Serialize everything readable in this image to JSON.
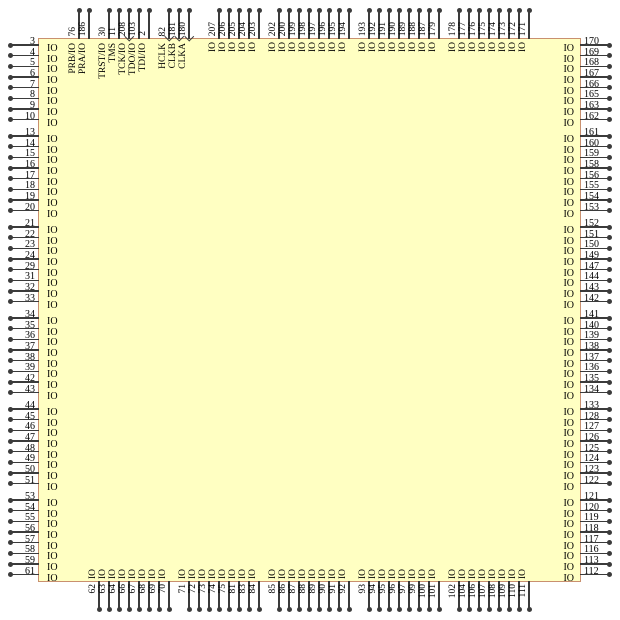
{
  "diagram": {
    "io_label": "IO",
    "chip_fill": "#FFFFC2",
    "chip_border": "#C9906F",
    "pin_color": "#3b3b3b"
  },
  "top_pins": {
    "special_groups": [
      {
        "pins": [
          {
            "number": "76",
            "label": "PRB/IO",
            "arrow": false
          },
          {
            "number": "186",
            "label": "PRA/IO",
            "arrow": false
          }
        ]
      },
      {
        "pins": [
          {
            "number": "30",
            "label": "TRST/IO",
            "arrow": false
          },
          {
            "number": "11",
            "label": "TMS",
            "arrow": false
          },
          {
            "number": "208",
            "label": "TCK/IO",
            "arrow": true
          },
          {
            "number": "103",
            "label": "TDO/IO",
            "arrow": false
          },
          {
            "number": "2",
            "label": "TDI/IO",
            "arrow": false
          }
        ]
      },
      {
        "pins": [
          {
            "number": "82",
            "label": "HCLK",
            "arrow": true
          },
          {
            "number": "181",
            "label": "CLKB",
            "arrow": true
          },
          {
            "number": "180",
            "label": "CLKA",
            "arrow": true
          }
        ]
      }
    ],
    "io_groups": [
      [
        "207",
        "206",
        "205",
        "204",
        "203"
      ],
      [
        "202",
        "200",
        "199",
        "198",
        "197",
        "196",
        "195",
        "194"
      ],
      [
        "193",
        "192",
        "191",
        "190",
        "189",
        "188",
        "187",
        "179"
      ],
      [
        "178",
        "177",
        "176",
        "175",
        "174",
        "173",
        "172",
        "171"
      ]
    ]
  },
  "left_pins": {
    "io_groups": [
      [
        "3",
        "4",
        "5",
        "6",
        "7",
        "8",
        "9",
        "10"
      ],
      [
        "13",
        "14",
        "15",
        "16",
        "17",
        "18",
        "19",
        "20"
      ],
      [
        "21",
        "22",
        "23",
        "24",
        "29",
        "31",
        "32",
        "33"
      ],
      [
        "34",
        "35",
        "36",
        "37",
        "38",
        "39",
        "42",
        "43"
      ],
      [
        "44",
        "45",
        "46",
        "47",
        "48",
        "49",
        "50",
        "51"
      ],
      [
        "53",
        "54",
        "55",
        "56",
        "57",
        "58",
        "59",
        "61"
      ]
    ]
  },
  "right_pins": {
    "io_groups": [
      [
        "170",
        "169",
        "168",
        "167",
        "166",
        "165",
        "163",
        "162"
      ],
      [
        "161",
        "160",
        "159",
        "158",
        "156",
        "155",
        "154",
        "153"
      ],
      [
        "152",
        "151",
        "150",
        "149",
        "147",
        "144",
        "143",
        "142"
      ],
      [
        "141",
        "140",
        "139",
        "138",
        "137",
        "136",
        "135",
        "134"
      ],
      [
        "133",
        "128",
        "127",
        "126",
        "125",
        "124",
        "123",
        "122"
      ],
      [
        "121",
        "120",
        "119",
        "118",
        "117",
        "116",
        "113",
        "112"
      ]
    ]
  },
  "bottom_pins": {
    "io_groups": [
      [
        "62",
        "63",
        "64",
        "66",
        "67",
        "68",
        "69",
        "70"
      ],
      [
        "71",
        "72",
        "73",
        "74",
        "75",
        "81",
        "83",
        "84"
      ],
      [
        "85",
        "86",
        "87",
        "88",
        "89",
        "90",
        "91",
        "92"
      ],
      [
        "93",
        "94",
        "95",
        "96",
        "97",
        "99",
        "100",
        "101"
      ],
      [
        "102",
        "104",
        "106",
        "107",
        "108",
        "109",
        "110",
        "111"
      ]
    ]
  }
}
